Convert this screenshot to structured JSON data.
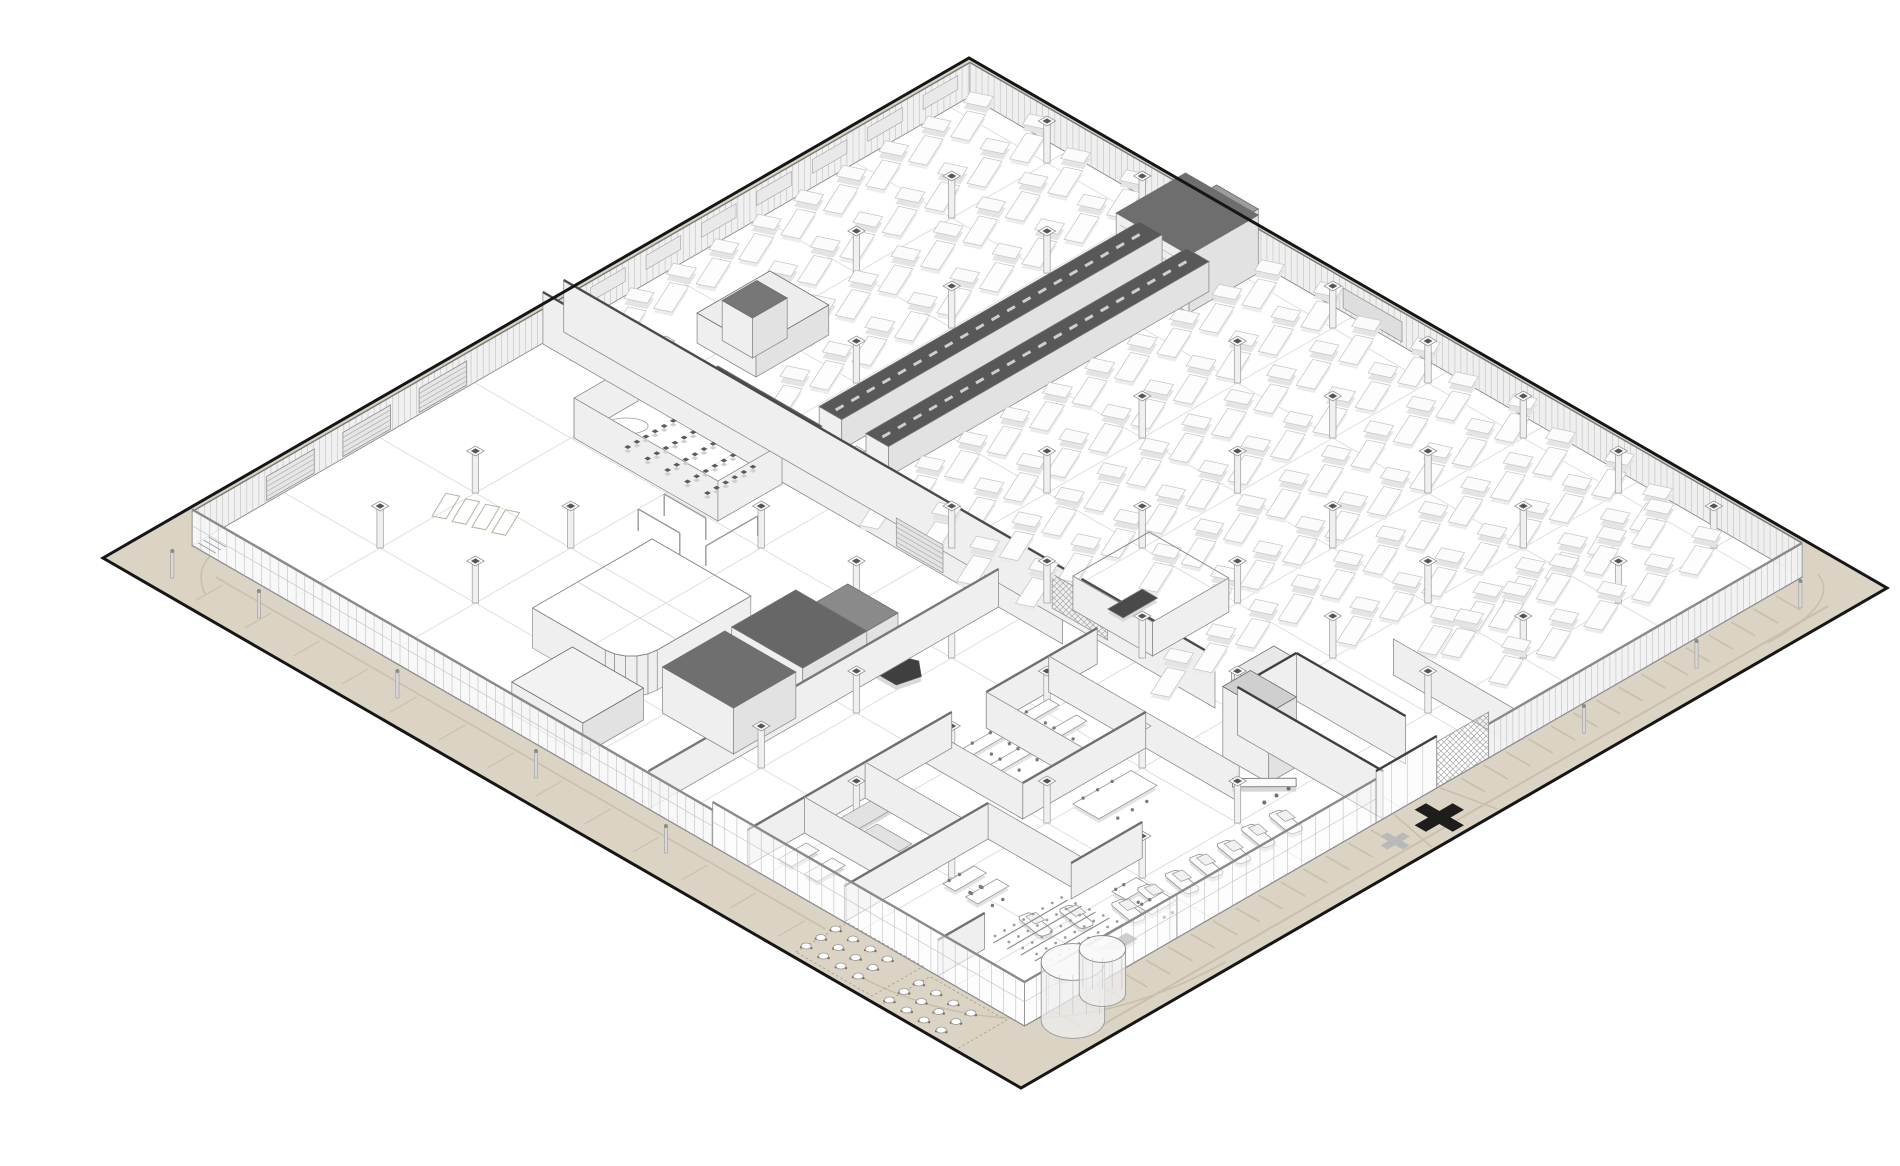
{
  "drawing": {
    "kind": "axonometric-architectural-floor-plan",
    "palette": {
      "background": "#ffffff",
      "site_fill": "#dbd4c5",
      "site_outline": "#161616",
      "apron_marking": "#c9c0ac",
      "floor_fill": "#ffffff",
      "floor_grid": "#dcdcdc",
      "wall_face": "#efefef",
      "wall_face_dark": "#e2e2e2",
      "wall_stroke": "#8e8e8e",
      "corrugation": "#c0c0c0",
      "dark_cap": "#474747",
      "dark_roof": "#6b6b6b",
      "machine_fill": "#fbfbfb",
      "machine_stroke": "#c9c9c9",
      "machine_shadow": "#e4e4e4",
      "column_fill": "#f0f0f0",
      "column_stroke": "#9a9a9a",
      "column_cap": "#555555",
      "furniture_stroke": "#9a9a9a",
      "furniture_dark": "#4f4f4f",
      "marker_black": "#1d1d1d",
      "marker_gray": "#b9b9b9"
    },
    "iso": {
      "origin": [
        63,
        542
      ],
      "k": 0.8660254
    },
    "site": {
      "U": 1000,
      "V": 1060
    },
    "building": {
      "u1": 64,
      "v1": 39,
      "u2": 962,
      "v2": 1000,
      "wallH": 34
    },
    "floor_grid": {
      "us": [
        170,
        280,
        390,
        500,
        610,
        720,
        830,
        940
      ],
      "vs": [
        150,
        260,
        370,
        480,
        590,
        700,
        810,
        920
      ]
    },
    "apron": {
      "seLane": [
        [
          92,
          1044
        ],
        [
          948,
          1044
        ]
      ],
      "seTicks": {
        "v1": 1004,
        "v2": 1032,
        "u0": 96,
        "u1": 948,
        "du": 26,
        "skipFrom": 464,
        "skipTo": 556
      },
      "swLane": [
        [
          46,
          84
        ],
        [
          46,
          788
        ]
      ],
      "swTicks": {
        "u1": 12,
        "u2": 42,
        "v0": 96,
        "v1": 780,
        "dv": 56
      },
      "drive": [
        [
          [
            489,
            1002
          ],
          [
            478,
            1056
          ]
        ],
        [
          [
            542,
            1002
          ],
          [
            554,
            1056
          ]
        ]
      ],
      "arcs": [
        [
          [
            18,
            852
          ],
          [
            28,
            1048
          ],
          [
            244,
            1052
          ]
        ],
        [
          [
            876,
            1046
          ],
          [
            960,
            1048
          ],
          [
            974,
            1006
          ]
        ],
        [
          [
            64,
            60
          ],
          [
            40,
            66
          ],
          [
            22,
            96
          ]
        ]
      ]
    },
    "nw_wall": {
      "doors": [
        [
          150,
          205
        ],
        [
          238,
          293
        ],
        [
          326,
          381
        ]
      ],
      "windows": {
        "u0": 524,
        "u1": 936,
        "du": 64,
        "w": 40
      }
    },
    "ne_wall": {
      "louver": [
        470,
        538
      ]
    },
    "machines": {
      "regions": [
        {
          "u0": 508,
          "u1": 951,
          "du": 49,
          "v0": 62,
          "v1": 846,
          "dv": 56,
          "stagger": 12
        },
        {
          "u0": 660,
          "u1": 940,
          "du": 55,
          "v0": 862,
          "v1": 920,
          "dv": 55,
          "stagger": 0
        }
      ],
      "excl": [
        [
          528,
          266,
          924,
          398
        ],
        [
          856,
          276,
          968,
          398
        ],
        [
          546,
          116,
          654,
          206
        ],
        [
          498,
          596,
          606,
          714
        ],
        [
          450,
          776,
          666,
          1012
        ]
      ]
    },
    "columns": {
      "us": [
        170,
        280,
        390,
        500,
        610,
        720,
        830,
        940
      ],
      "vs": [
        150,
        260,
        370,
        480,
        590,
        700,
        810,
        920
      ],
      "excl": [
        [
          528,
          266,
          924,
          398
        ],
        [
          856,
          276,
          968,
          398
        ],
        [
          378,
          138,
          472,
          332
        ],
        [
          158,
          468,
          332,
          572
        ],
        [
          144,
          348,
          302,
          478
        ],
        [
          108,
          883,
          228,
          994
        ],
        [
          440,
          830,
          560,
          1010
        ]
      ]
    },
    "hall_items": [
      {
        "t": "wallV",
        "u": 468,
        "v1": 40,
        "v2": 640,
        "h": 52,
        "cap": "#4a4a4a"
      },
      {
        "t": "wallV",
        "u": 492,
        "v1": 40,
        "v2": 792,
        "h": 52,
        "cap": "#4a4a4a"
      },
      {
        "t": "prism",
        "u1": 468,
        "v1": 218,
        "u2": 492,
        "v2": 338,
        "h": 55,
        "top": "#4f4f4f"
      },
      {
        "t": "louverV",
        "u": 468,
        "v1": 448,
        "v2": 502,
        "h": 30
      },
      {
        "t": "hatchV",
        "u": 498,
        "v1": 598,
        "v2": 662,
        "h": 34
      },
      {
        "t": "prism",
        "u1": 535,
        "v1": 292,
        "u2": 905,
        "v2": 318,
        "h": 30,
        "top": "#585858",
        "dash": true
      },
      {
        "t": "prism",
        "u1": 535,
        "v1": 346,
        "u2": 905,
        "v2": 372,
        "h": 30,
        "top": "#585858",
        "dash": true
      },
      {
        "t": "prism",
        "u1": 905,
        "v1": 292,
        "u2": 938,
        "v2": 372,
        "h": 24,
        "top": "#8f8f8f"
      },
      {
        "t": "prism",
        "u1": 872,
        "v1": 298,
        "u2": 952,
        "v2": 382,
        "h": 58,
        "top": "#6e6e6e",
        "louvers": true
      },
      {
        "t": "prism",
        "u1": 962,
        "v1": 300,
        "u2": 986,
        "v2": 348,
        "h": 30,
        "top": "#9c9c9c"
      },
      {
        "t": "prism",
        "u1": 558,
        "v1": 128,
        "u2": 642,
        "v2": 196,
        "h": 30,
        "top": "#ededed"
      },
      {
        "t": "prism",
        "u1": 575,
        "v1": 140,
        "u2": 615,
        "v2": 175,
        "h": 40,
        "top": "#777777"
      },
      {
        "t": "wallV",
        "u": 392,
        "v1": 152,
        "v2": 318,
        "h": 40
      },
      {
        "t": "wallU",
        "v": 318,
        "u1": 392,
        "u2": 466,
        "h": 40
      },
      {
        "t": "wallU",
        "v": 152,
        "u1": 392,
        "u2": 466,
        "h": 40
      },
      {
        "t": "chairs",
        "u0": 404,
        "v0": 198,
        "cols": 6,
        "rows": 5,
        "du": 10.5,
        "dv": 23,
        "s": 4,
        "fill": "#5a5a5a"
      },
      {
        "t": "ellipse",
        "u": 432,
        "v": 172,
        "ru": 20,
        "rv": 8
      },
      {
        "t": "roundRoom",
        "u1": 158,
        "v1": 338,
        "u2": 296,
        "v2": 452,
        "r": 30,
        "h": 40
      },
      {
        "t": "prism",
        "u1": 168,
        "v1": 478,
        "u2": 240,
        "v2": 560,
        "h": 46,
        "top": "#6f6f6f"
      },
      {
        "t": "prism",
        "u1": 248,
        "v1": 478,
        "u2": 322,
        "v2": 560,
        "h": 46,
        "top": "#676767"
      },
      {
        "t": "prism",
        "u1": 330,
        "v1": 490,
        "u2": 370,
        "v2": 548,
        "h": 34,
        "top": "#8a8a8a"
      },
      {
        "t": "wallU",
        "v": 566,
        "u1": 64,
        "u2": 468,
        "h": 38,
        "cap": "#787878"
      },
      {
        "t": "prism",
        "u1": 80,
        "v1": 392,
        "u2": 150,
        "v2": 474,
        "h": 32,
        "top": "#f2f2f2"
      },
      {
        "t": "wallV",
        "u": 116,
        "v1": 392,
        "v2": 474,
        "h": 32
      },
      {
        "t": "frame",
        "u1": 336,
        "v1": 282,
        "u2": 336,
        "v2": 330,
        "h": 22
      },
      {
        "t": "frame",
        "u1": 366,
        "v1": 282,
        "u2": 366,
        "v2": 330,
        "h": 22
      },
      {
        "t": "frame",
        "u1": 340,
        "v1": 356,
        "u2": 400,
        "v2": 356,
        "h": 20
      },
      {
        "t": "marks",
        "u0": 232,
        "v0": 148,
        "n": 4,
        "w": 34,
        "hh": 12,
        "dv": 17,
        "rot": -0.45
      },
      {
        "t": "planPoly",
        "pts": [
          [
            315,
            575
          ],
          [
            346,
            575
          ],
          [
            352,
            590
          ],
          [
            338,
            607
          ],
          [
            315,
            601
          ]
        ],
        "z": 16,
        "fill": "#3f3f3f",
        "shadow": true
      },
      {
        "t": "room3",
        "u1": 508,
        "v1": 612,
        "u2": 596,
        "v2": 704,
        "h": 34
      },
      {
        "t": "rect",
        "u1": 520,
        "v1": 640,
        "u2": 560,
        "v2": 658,
        "z": 9,
        "fill": "#4a4a4a"
      },
      {
        "t": "prism",
        "u1": 505,
        "v1": 798,
        "u2": 554,
        "v2": 828,
        "h": 34,
        "top": "#e8e8e8",
        "gridFace": true
      },
      {
        "t": "wallU",
        "v": 680,
        "u1": 64,
        "u2": 300,
        "h": 36,
        "cap": "#6f6f6f"
      },
      {
        "t": "wallU",
        "v": 680,
        "u1": 340,
        "u2": 468,
        "h": 36,
        "cap": "#6f6f6f"
      },
      {
        "t": "wallU",
        "v": 792,
        "u1": 64,
        "u2": 230,
        "h": 36,
        "cap": "#6f6f6f"
      },
      {
        "t": "wallU",
        "v": 792,
        "u1": 270,
        "u2": 412,
        "h": 36,
        "cap": "#6f6f6f"
      },
      {
        "t": "wallU",
        "v": 900,
        "u1": 64,
        "u2": 118,
        "h": 36,
        "cap": "#6f6f6f"
      },
      {
        "t": "wallU",
        "v": 900,
        "u1": 218,
        "u2": 300,
        "h": 36,
        "cap": "#6f6f6f"
      },
      {
        "t": "wallV",
        "u": 130,
        "v1": 680,
        "v2": 790,
        "h": 36
      },
      {
        "t": "wallV",
        "u": 200,
        "v1": 680,
        "v2": 790,
        "h": 36
      },
      {
        "t": "wallV",
        "u": 270,
        "v1": 680,
        "v2": 792,
        "h": 36
      },
      {
        "t": "wallV",
        "u": 340,
        "v1": 680,
        "v2": 792,
        "h": 36
      },
      {
        "t": "wallV",
        "u": 412,
        "v1": 680,
        "v2": 900,
        "h": 36
      },
      {
        "t": "wallV",
        "u": 230,
        "v1": 792,
        "v2": 900,
        "h": 36
      },
      {
        "t": "rect",
        "u1": 150,
        "v1": 695,
        "u2": 196,
        "v2": 716,
        "z": 9,
        "fill": "#e2e2e2"
      },
      {
        "t": "rect",
        "u1": 150,
        "v1": 722,
        "u2": 172,
        "v2": 762,
        "z": 9,
        "fill": "#e2e2e2"
      },
      {
        "t": "table",
        "u1": 292,
        "v1": 696,
        "u2": 396,
        "v2": 708,
        "z": 9,
        "chairs": 8
      },
      {
        "t": "table",
        "u1": 292,
        "v1": 728,
        "u2": 396,
        "v2": 740,
        "z": 9,
        "chairs": 8
      },
      {
        "t": "rect",
        "u1": 80,
        "v1": 700,
        "u2": 112,
        "v2": 715,
        "z": 9,
        "fill": "#fafafa"
      },
      {
        "t": "rect",
        "u1": 80,
        "v1": 730,
        "u2": 112,
        "v2": 745,
        "z": 9,
        "fill": "#fafafa"
      },
      {
        "t": "table",
        "u1": 150,
        "v1": 820,
        "u2": 186,
        "v2": 834,
        "z": 9,
        "chairs": 3
      },
      {
        "t": "table",
        "u1": 150,
        "v1": 846,
        "u2": 186,
        "v2": 860,
        "z": 9,
        "chairs": 3
      },
      {
        "t": "table",
        "u1": 305,
        "v1": 815,
        "u2": 372,
        "v2": 845,
        "z": 9,
        "chairs": 6
      },
      {
        "t": "table",
        "u1": 240,
        "v1": 925,
        "u2": 268,
        "v2": 941,
        "z": 9,
        "chairs": 3
      },
      {
        "t": "table",
        "u1": 240,
        "v1": 955,
        "u2": 268,
        "v2": 971,
        "z": 9,
        "chairs": 3
      },
      {
        "t": "reception",
        "u": 436,
        "v": 905,
        "len": 52,
        "wid": 12,
        "rot": 0.78,
        "stools": 3
      },
      {
        "t": "steps",
        "u1": 126,
        "v1": 902,
        "u2": 212,
        "v2": 966,
        "rows": 5
      },
      {
        "t": "rect",
        "u1": 126,
        "v1": 970,
        "u2": 212,
        "v2": 982,
        "z": 4,
        "fill": "#8a8a8a"
      },
      {
        "t": "prism",
        "u1": 448,
        "v1": 845,
        "u2": 480,
        "v2": 898,
        "h": 70,
        "top": "#cfcfcf"
      },
      {
        "t": "wallV",
        "u": 478,
        "v1": 832,
        "v2": 1000,
        "h": 48,
        "cap": "#3f3f3f"
      },
      {
        "t": "wallV",
        "u": 546,
        "v1": 832,
        "v2": 958,
        "h": 48,
        "cap": "#3f3f3f"
      },
      {
        "t": "wallU",
        "v": 832,
        "u1": 478,
        "u2": 546,
        "h": 48,
        "cap": "#3f3f3f"
      },
      {
        "t": "wallV",
        "u": 628,
        "v1": 862,
        "v2": 1000,
        "h": 36
      },
      {
        "t": "car",
        "u": 232,
        "v": 952
      },
      {
        "t": "car",
        "u": 262,
        "v": 952
      },
      {
        "t": "car",
        "u": 292,
        "v": 954
      },
      {
        "t": "car",
        "u": 322,
        "v": 952
      },
      {
        "t": "car",
        "u": 352,
        "v": 954
      },
      {
        "t": "car",
        "u": 382,
        "v": 952
      },
      {
        "t": "car",
        "u": 412,
        "v": 954
      },
      {
        "t": "car",
        "u": 165,
        "v": 912
      },
      {
        "t": "car",
        "u": 196,
        "v": 928
      }
    ],
    "facades": [
      {
        "kind": "V",
        "u": 64,
        "v1": 39,
        "v2": 640,
        "h": 36,
        "fill": "rgba(247,247,247,0.82)",
        "mull": 10,
        "hline": true
      },
      {
        "kind": "V",
        "u": 64,
        "v1": 640,
        "v2": 1000,
        "h": 44,
        "fill": "rgba(252,252,252,0.55)",
        "mull": 14,
        "hline": true
      },
      {
        "kind": "U",
        "v": 1000,
        "u1": 64,
        "u2": 240,
        "h": 44,
        "fill": "rgba(252,252,252,0.6)",
        "mull": 14,
        "hline": true
      },
      {
        "kind": "U",
        "v": 1000,
        "u1": 240,
        "u2": 470,
        "h": 44,
        "fill": "rgba(252,252,252,0.5)",
        "mull": 16,
        "hline": true
      },
      {
        "kind": "U",
        "v": 1000,
        "u1": 470,
        "u2": 540,
        "h": 52,
        "fill": "rgba(250,250,250,0.55)",
        "mull": 18,
        "cap": "#3f3f3f"
      },
      {
        "kind": "U",
        "v": 1000,
        "u1": 600,
        "u2": 962,
        "h": 34,
        "fill": "rgba(241,241,241,0.93)",
        "mull": 7
      },
      {
        "kind": "mesh",
        "v": 1000,
        "u1": 540,
        "u2": 600,
        "h": 46
      }
    ],
    "outdoor": [
      {
        "t": "stairs",
        "u": 70,
        "v": 54,
        "n": 3
      },
      {
        "t": "patio",
        "u0": 12,
        "v0": 800,
        "cols": 3,
        "rows": 4,
        "du": 17,
        "dv": 20
      },
      {
        "t": "patio",
        "u0": 6,
        "v0": 902,
        "cols": 3,
        "rows": 4,
        "du": 17,
        "dv": 20
      },
      {
        "t": "cyl",
        "u": 98,
        "v": 1022,
        "r": 26,
        "h": 58
      },
      {
        "t": "cyl",
        "u": 142,
        "v": 1012,
        "r": 19,
        "h": 44
      },
      {
        "t": "cross",
        "u": 511,
        "v": 1032,
        "s": 22,
        "w": 6.5,
        "fill": "#1d1d1d"
      },
      {
        "t": "cross",
        "u": 462,
        "v": 1030,
        "s": 13,
        "w": 4,
        "fill": "#b9b9b9"
      },
      {
        "t": "pole",
        "u": 30,
        "v": 150
      },
      {
        "t": "pole",
        "u": 30,
        "v": 310
      },
      {
        "t": "pole",
        "u": 30,
        "v": 470
      },
      {
        "t": "pole",
        "u": 30,
        "v": 620
      },
      {
        "t": "pole",
        "u": 20,
        "v": 60
      },
      {
        "t": "pole",
        "u": 680,
        "v": 1030
      },
      {
        "t": "pole",
        "u": 810,
        "v": 1030
      },
      {
        "t": "pole",
        "u": 930,
        "v": 1030
      }
    ]
  }
}
